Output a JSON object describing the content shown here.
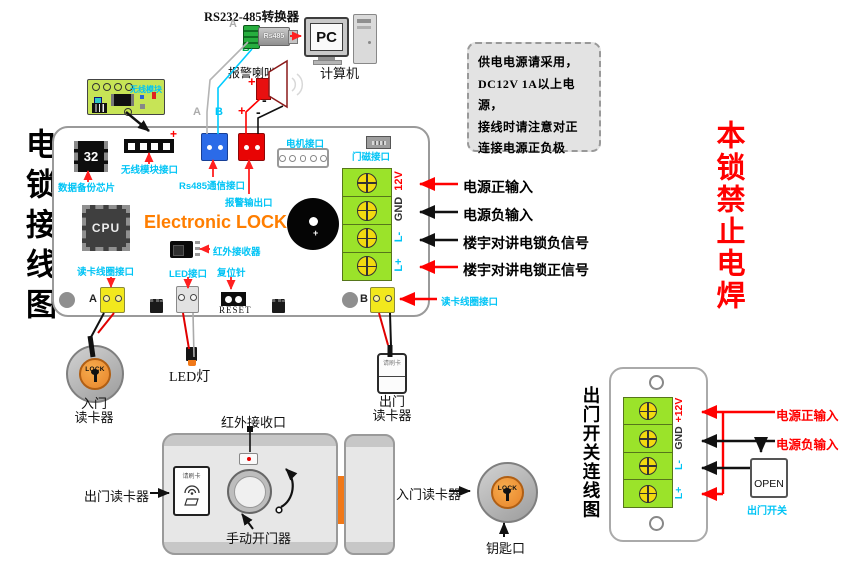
{
  "page": {
    "left_title": "电锁接线图",
    "right_warning": "本锁禁止电焊"
  },
  "note": {
    "line1": "供电电源请采用，",
    "line2": "DC12V 1A以上电源，",
    "line3": "接线时请注意对正",
    "line4": "连接电源正负极"
  },
  "top": {
    "converter_title": "RS232-485转换器",
    "converter_chip": "Rs485",
    "pc": "PC",
    "computer": "计算机",
    "speaker": "报警喇叭",
    "label_a": "A",
    "label_b": "B",
    "plus": "+",
    "minus": "-"
  },
  "board": {
    "brand": "Electronic LOCK",
    "cpu": "CPU",
    "chip32": "32",
    "reset": "RESET",
    "label_a": "A",
    "label_b": "B",
    "plus": "+",
    "wireless_module": "无线模块",
    "wireless_module_port": "无线模块接口",
    "backup_chip": "数据备份芯片",
    "rs485_port": "Rs485通信接口",
    "alarm_output": "报警输出口",
    "motor_port": "电机接口",
    "door_magnet_port": "门磁接口",
    "ir_receiver": "红外接收器",
    "card_coil_port": "读卡线圈接口",
    "led_port": "LED接口",
    "reset_pin": "复位针",
    "t12v": "12V",
    "gnd": "GND",
    "lm": "L-",
    "lp": "L+"
  },
  "callouts": {
    "power_pos": "电源正输入",
    "power_neg": "电源负输入",
    "intercom_neg": "楼宇对讲电锁负信号",
    "intercom_pos": "楼宇对讲电锁正信号",
    "card_coil": "读卡线圈接口"
  },
  "devices": {
    "entry_reader_line1": "入门",
    "entry_reader_line2": "读卡器",
    "exit_reader_line1": "出门",
    "exit_reader_line2": "读卡器",
    "led_light": "LED灯",
    "lock_button": "LOCK",
    "swipe_card": "请刷卡"
  },
  "assembly": {
    "ir_port": "红外接收口",
    "exit_reader": "出门读卡器",
    "manual_opener": "手动开门器",
    "entry_reader": "入门读卡器",
    "key_hole": "钥匙口",
    "swipe_card": "请刷卡",
    "lock_button": "LOCK"
  },
  "exit_switch": {
    "title": "出门开关连线图",
    "t12v": "+12V",
    "gnd": "GND",
    "lm": "L-",
    "lp": "L+",
    "power_pos": "电源正输入",
    "power_neg": "电源负输入",
    "open": "OPEN",
    "open_label": "出门开关"
  },
  "colors": {
    "accent_cyan": "#00C4F5",
    "warning_red": "#FF0000",
    "brand_orange": "#FF7E00",
    "terminal_green": "#9BE32A",
    "screw_yellow": "#F2DA10"
  }
}
